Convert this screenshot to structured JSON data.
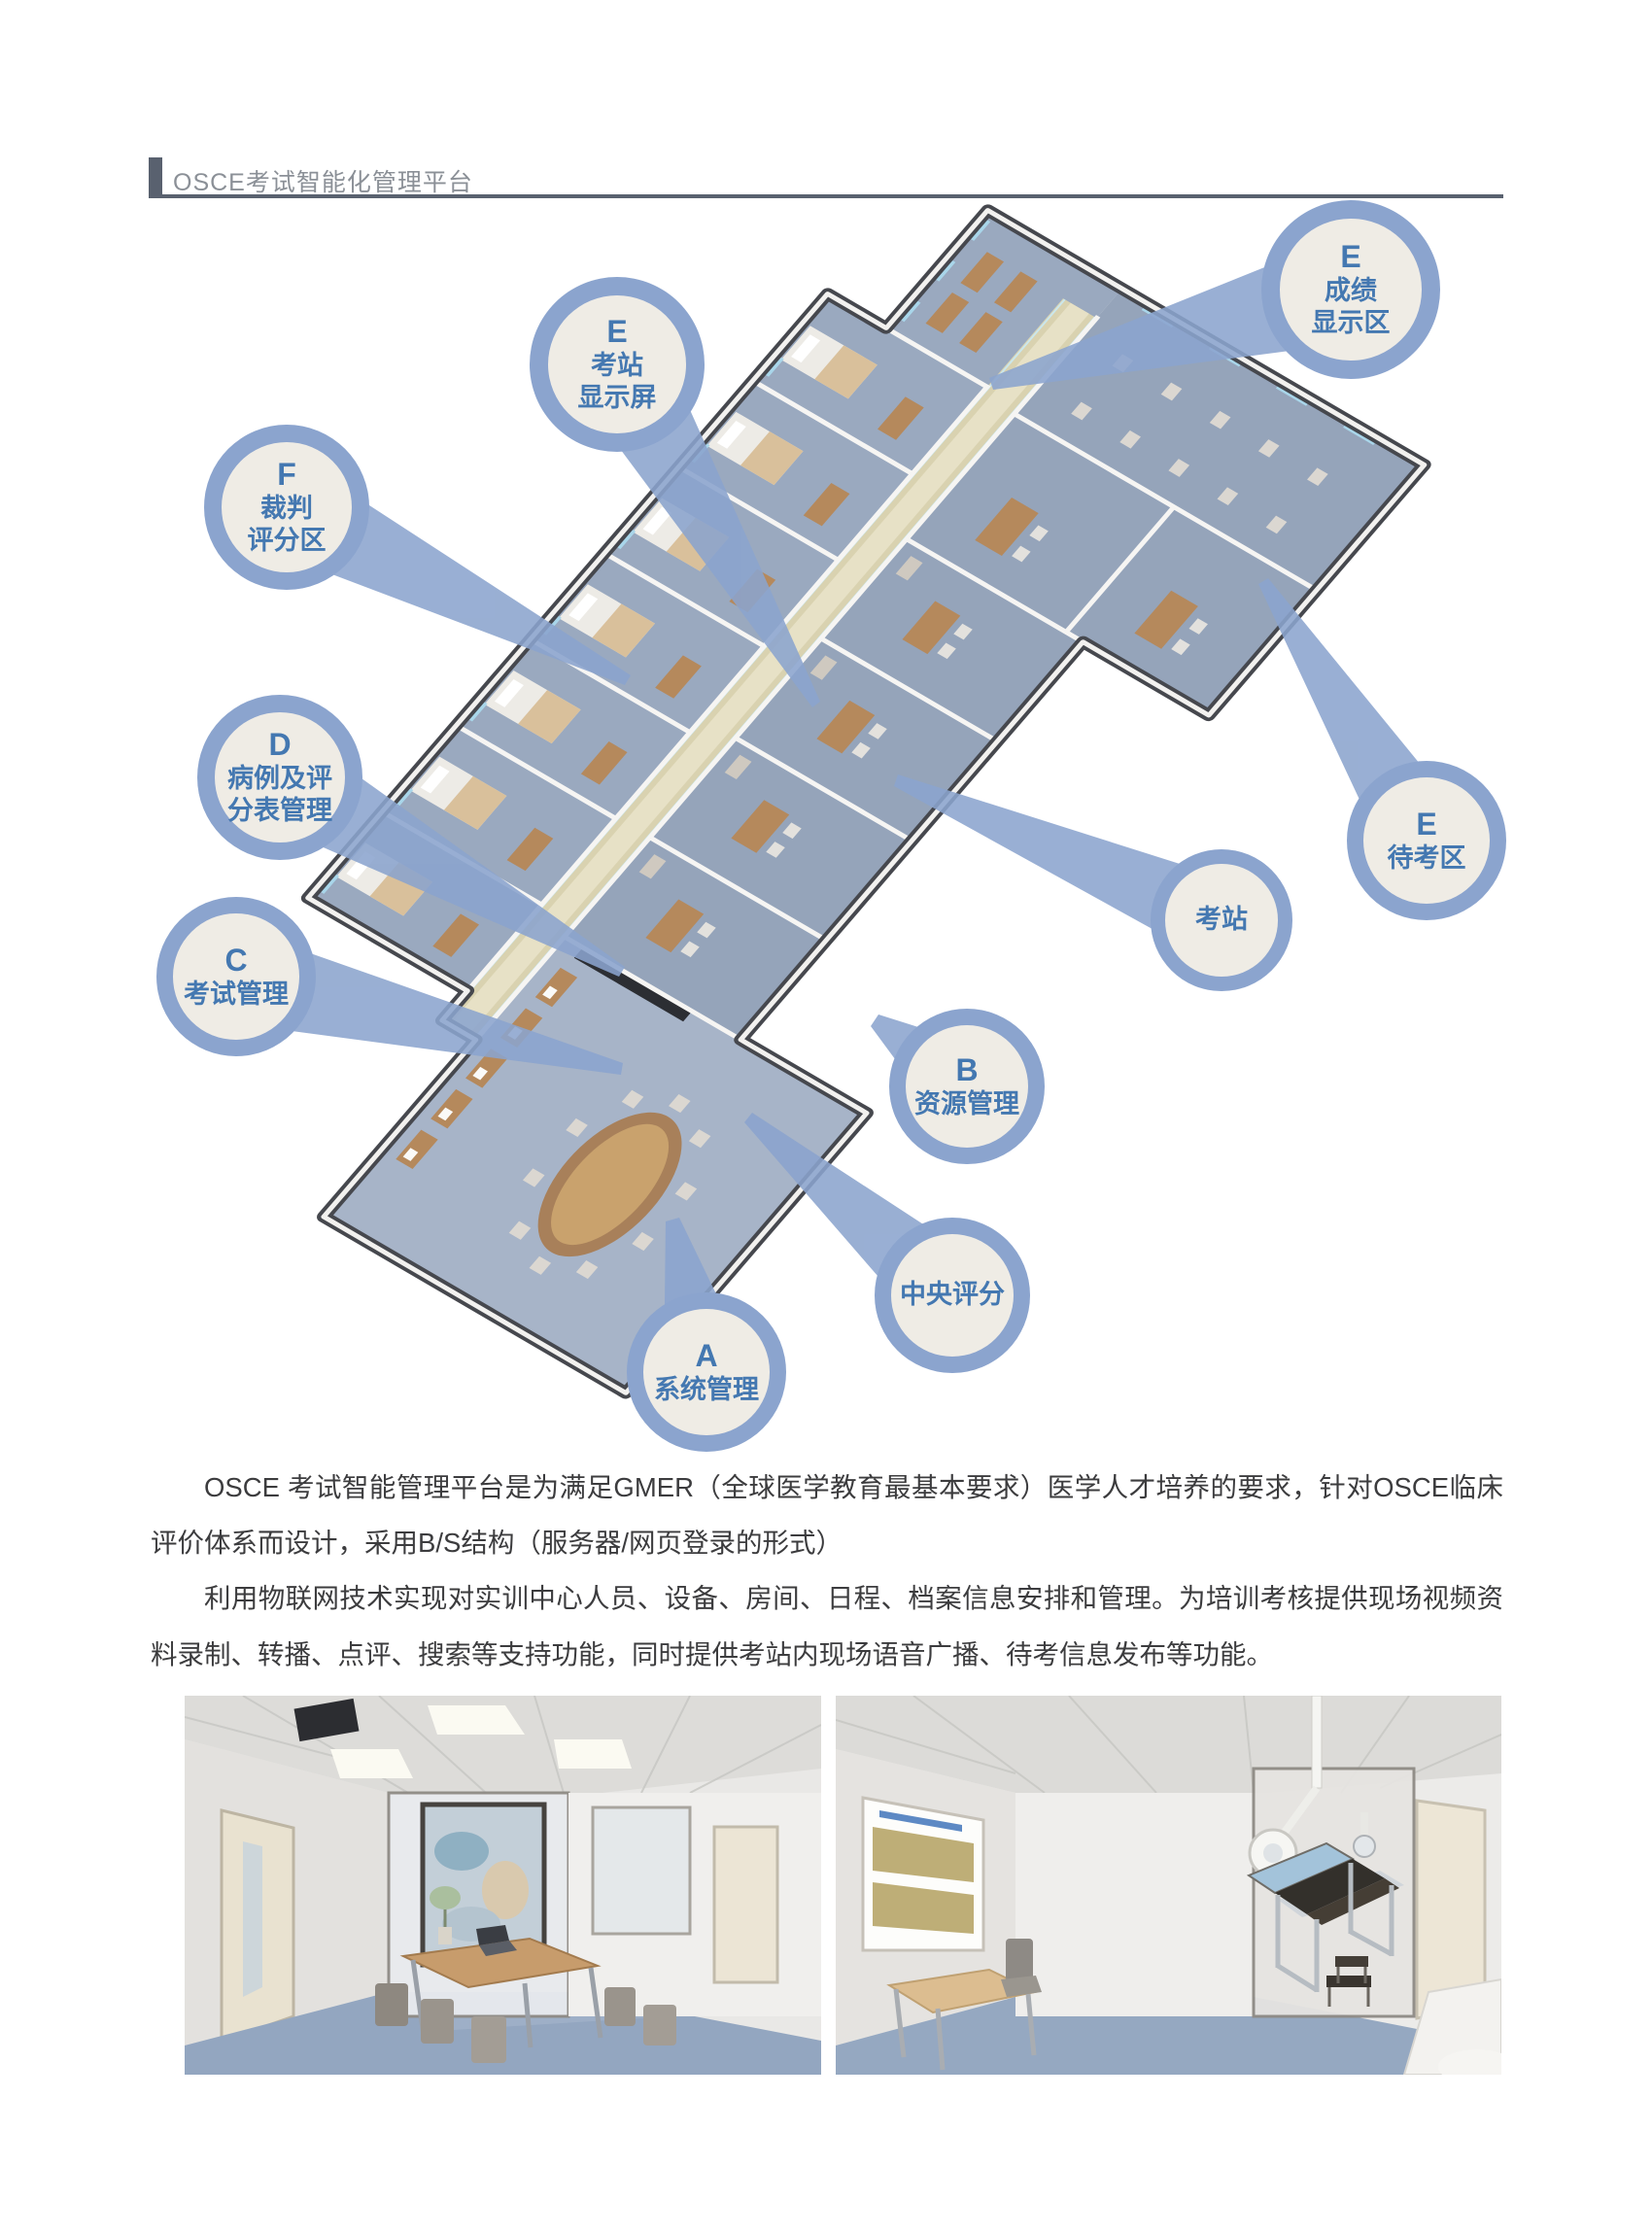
{
  "header": {
    "title": "OSCE考试智能化管理平台"
  },
  "diagram": {
    "description": "isometric-3d-floorplan-of-osce-exam-center",
    "bubbles": [
      {
        "id": "station-display",
        "letter": "E",
        "lines": [
          "考站",
          "显示屏"
        ]
      },
      {
        "id": "score-display",
        "letter": "E",
        "lines": [
          "成绩",
          "显示区"
        ]
      },
      {
        "id": "judge-scoring",
        "letter": "F",
        "lines": [
          "裁判",
          "评分区"
        ]
      },
      {
        "id": "case-scoresheet",
        "letter": "D",
        "lines": [
          "病例及评",
          "分表管理"
        ]
      },
      {
        "id": "exam-mgmt",
        "letter": "C",
        "lines": [
          "考试管理"
        ]
      },
      {
        "id": "waiting-area",
        "letter": "E",
        "lines": [
          "待考区"
        ]
      },
      {
        "id": "exam-station",
        "letter": "",
        "lines": [
          "考站"
        ]
      },
      {
        "id": "resource-mgmt",
        "letter": "B",
        "lines": [
          "资源管理"
        ]
      },
      {
        "id": "central-scoring",
        "letter": "",
        "lines": [
          "中央评分"
        ]
      },
      {
        "id": "system-mgmt",
        "letter": "A",
        "lines": [
          "系统管理"
        ]
      }
    ],
    "colors": {
      "bubble_ring": "#8ba4ce",
      "bubble_fill": "#efece5",
      "bubble_text": "#4478b1",
      "tail": "#8ba4ce",
      "corridor_floor": "#d9d2b0",
      "room_floor": "#98a7bd",
      "header_accent": "#59616f"
    }
  },
  "paragraphs": [
    "OSCE 考试智能管理平台是为满足GMER（全球医学教育最基本要求）医学人才培养的要求，针对OSCE临床评价体系而设计，采用B/S结构（服务器/网页登录的形式）",
    "利用物联网技术实现对实训中心人员、设备、房间、日程、档案信息安排和管理。为培训考核提供现场视频资料录制、转播、点评、搜索等支持功能，同时提供考站内现场语音广播、待考信息发布等功能。"
  ]
}
